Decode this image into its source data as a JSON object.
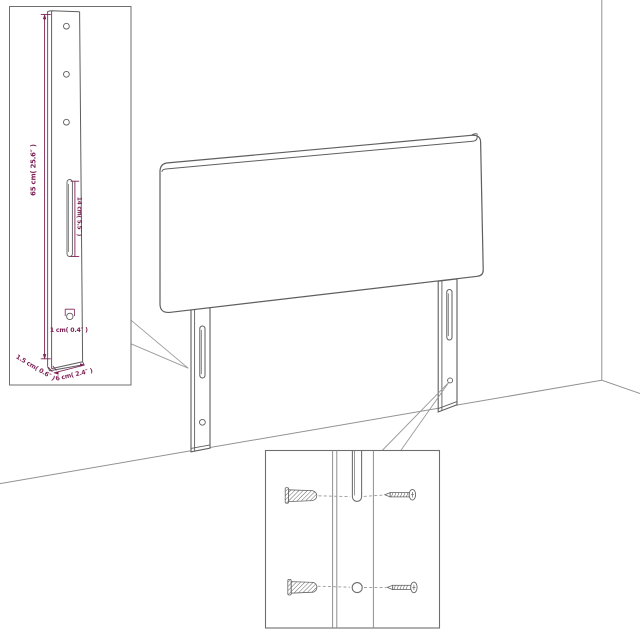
{
  "figure": {
    "kind": "furniture-assembly-diagram",
    "subject": "upholstered headboard with two slotted legs standing in a room corner"
  },
  "colors": {
    "background": "#ffffff",
    "product_outline": "#5e5e5e",
    "room_line": "#929292",
    "inset_border": "#6f6f6f",
    "dimension_text": "#7d2256",
    "fastener_line": "#666666"
  },
  "leg_detail": {
    "dim_leg_height": "65 cm( 25.6″ )",
    "dim_slot_length": "14 cm( 5.5″ )",
    "dim_bottom_hole": "1 cm( 0.4″ )",
    "dim_leg_thickness": "1.5 cm( 0.6″ )",
    "dim_leg_width": "6 cm( 2.4″ )"
  },
  "hardware_detail": {
    "items": [
      "wall-plug",
      "screw",
      "wall-plug",
      "screw"
    ]
  }
}
